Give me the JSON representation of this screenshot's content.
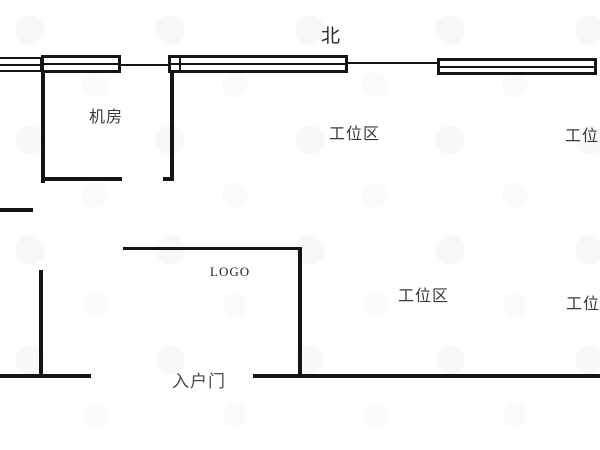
{
  "compass": {
    "north_label": "北"
  },
  "rooms": {
    "machine_room": "机房",
    "workstation_area": "工位区",
    "logo_area": "LOGO",
    "entrance_door": "入户门"
  },
  "colors": {
    "wall": "#141414",
    "label_text": "#3a3a3a",
    "background": "#ffffff"
  },
  "floorplan": {
    "walls": [
      {
        "name": "wall-top-thin-left",
        "x": 119,
        "y": 64,
        "w": 51,
        "h": 2
      },
      {
        "name": "wall-top-thin-right",
        "x": 346,
        "y": 62,
        "w": 93,
        "h": 2
      },
      {
        "name": "wall-machine-room-left",
        "x": 41,
        "y": 62,
        "w": 4,
        "h": 121
      },
      {
        "name": "wall-machine-room-right",
        "x": 170,
        "y": 68,
        "w": 4,
        "h": 113
      },
      {
        "name": "wall-machine-room-right-foot",
        "x": 163,
        "y": 177,
        "w": 11,
        "h": 4
      },
      {
        "name": "wall-machine-room-bottom",
        "x": 41,
        "y": 177,
        "w": 81,
        "h": 4
      },
      {
        "name": "wall-left-stub",
        "x": 0,
        "y": 208,
        "w": 33,
        "h": 4
      },
      {
        "name": "wall-lower-left-vertical",
        "x": 39,
        "y": 270,
        "w": 4,
        "h": 108
      },
      {
        "name": "wall-bottom-left",
        "x": 0,
        "y": 374,
        "w": 91,
        "h": 4
      },
      {
        "name": "wall-bottom-right",
        "x": 253,
        "y": 374,
        "w": 347,
        "h": 4
      },
      {
        "name": "wall-logo-partition-top",
        "x": 123,
        "y": 247,
        "w": 179,
        "h": 3
      },
      {
        "name": "wall-logo-partition-right",
        "x": 298,
        "y": 247,
        "w": 4,
        "h": 131
      }
    ],
    "windows": [
      {
        "name": "window-top-far-left",
        "x": -4,
        "y": 57,
        "w": 46,
        "h": 15,
        "bw": 2
      },
      {
        "name": "window-top-left",
        "x": 41,
        "y": 55,
        "w": 80,
        "h": 18,
        "bw": 3
      },
      {
        "name": "window-top-middle",
        "x": 168,
        "y": 55,
        "w": 180,
        "h": 18,
        "bw": 3,
        "junction_left": 8
      },
      {
        "name": "window-top-right",
        "x": 437,
        "y": 58,
        "w": 160,
        "h": 17,
        "bw": 3
      }
    ],
    "labels": [
      {
        "name": "north-label",
        "text": "北",
        "x": 321,
        "y": 27,
        "size": 19,
        "color": "#2b2b2b"
      },
      {
        "name": "room-label-machine-room",
        "text": "机房",
        "x": 89,
        "y": 109,
        "size": 16,
        "color": "#3a3a3a"
      },
      {
        "name": "room-label-workstation-top",
        "text": "工位区",
        "x": 329,
        "y": 126,
        "size": 16,
        "color": "#3a3a3a"
      },
      {
        "name": "room-label-workstation-top-right",
        "text": "工位区",
        "x": 565,
        "y": 128,
        "size": 16,
        "color": "#3a3a3a"
      },
      {
        "name": "logo-label",
        "text": "LOGO",
        "x": 210,
        "y": 265,
        "size": 13,
        "color": "#222222",
        "serif": true
      },
      {
        "name": "room-label-workstation-bottom",
        "text": "工位区",
        "x": 398,
        "y": 288,
        "size": 16,
        "color": "#3a3a3a"
      },
      {
        "name": "room-label-workstation-bottom-right",
        "text": "工位区",
        "x": 566,
        "y": 296,
        "size": 16,
        "color": "#3a3a3a"
      },
      {
        "name": "entrance-door-label",
        "text": "入户门",
        "x": 172,
        "y": 373,
        "size": 17,
        "color": "#4a4a4a"
      }
    ]
  }
}
